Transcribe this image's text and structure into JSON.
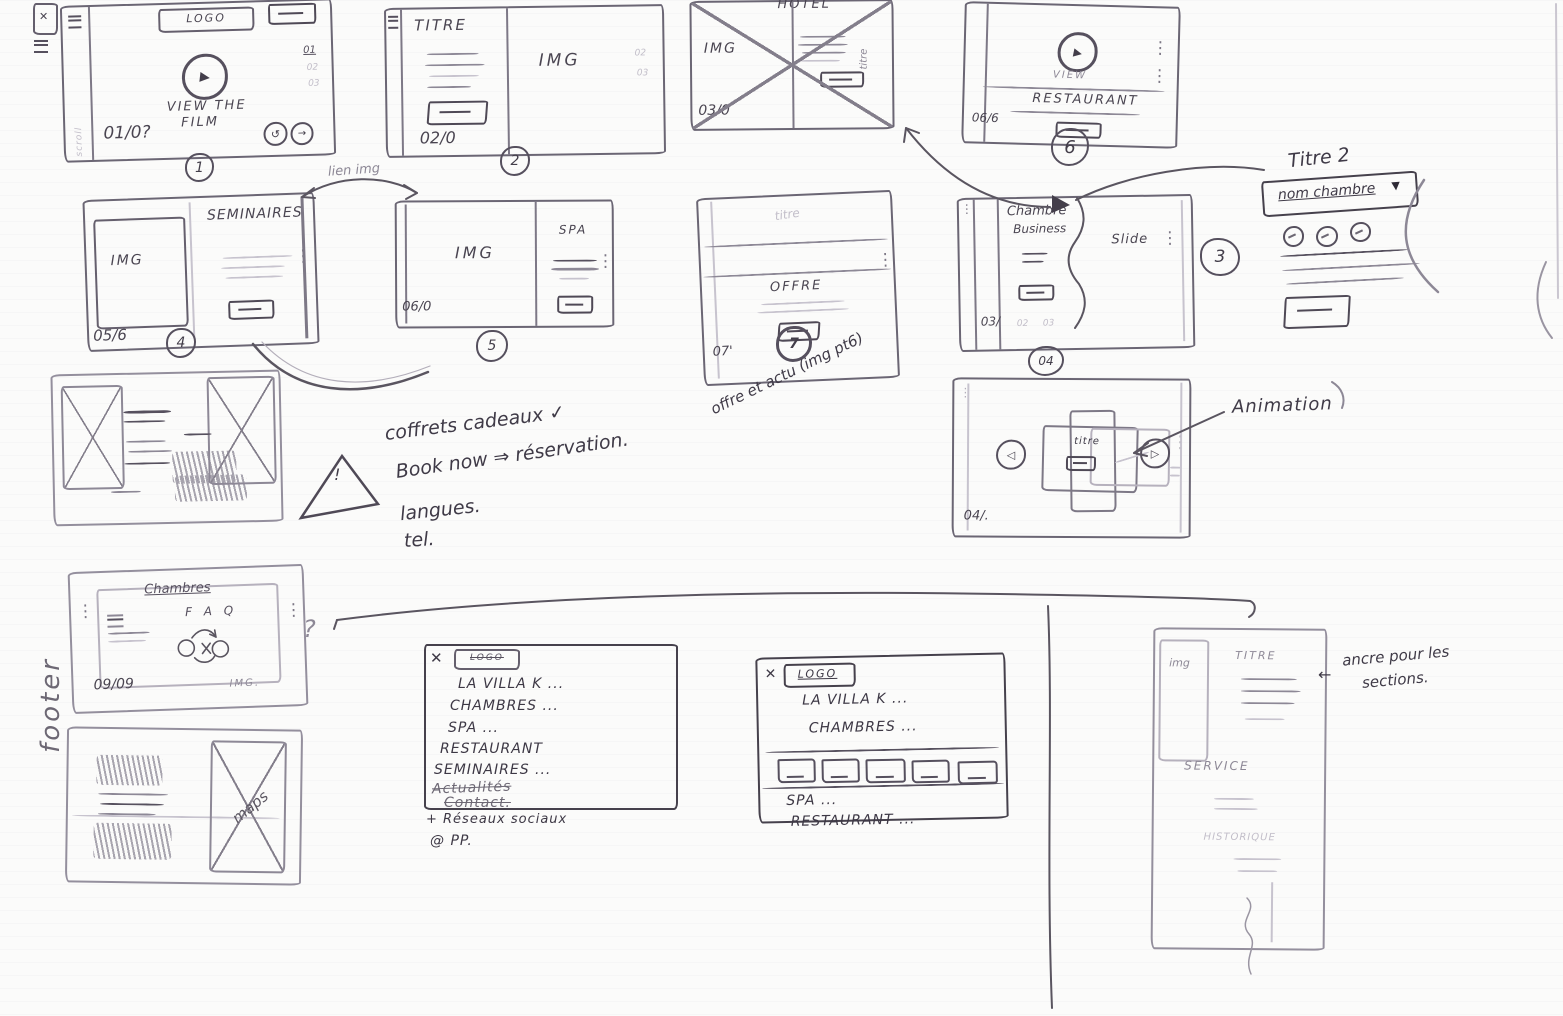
{
  "glyphs": {
    "close": "✕",
    "play": "▶",
    "prev": "◁",
    "next": "▷",
    "caret": "▼",
    "dots": "⋮",
    "loop": "↺",
    "arrow_right": "→",
    "arrow_left": "←"
  },
  "frames": {
    "home": {
      "logo": "LOGO",
      "cta_line1": "VIEW THE",
      "cta_line2": "FILM",
      "page": "01/0?",
      "badge": "1",
      "pager": [
        "01",
        "02",
        "03"
      ],
      "scroll": "scroll"
    },
    "titre": {
      "title": "TITRE",
      "img": "IMG",
      "page": "02/0",
      "badge": "2",
      "pager": [
        "02",
        "03"
      ]
    },
    "hotel": {
      "title": "HOTEL",
      "img": "IMG",
      "page": "03/0",
      "side_label": "titre"
    },
    "restaurant": {
      "view": "VIEW",
      "title": "RESTAURANT",
      "page": "06/6",
      "badge": "6"
    },
    "seminaires": {
      "img": "IMG",
      "title": "SEMINAIRES",
      "page": "05/6",
      "badge": "4"
    },
    "spa": {
      "img": "IMG",
      "title": "SPA",
      "page": "06/0",
      "badge": "5"
    },
    "offre": {
      "band": "titre",
      "title": "OFFRE",
      "page": "07'",
      "badge": "7"
    },
    "chambre": {
      "title_line1": "Chambre",
      "title_line2": "Business",
      "slide": "Slide",
      "page": "03/",
      "marks": [
        "02",
        "03"
      ],
      "badge_side": "3",
      "badge_below": "04"
    },
    "room_detail": {
      "title": "Titre 2",
      "dropdown": "nom chambre"
    },
    "animation": {
      "label": "Animation",
      "title": "titre",
      "page": "04/."
    },
    "faq": {
      "strike_title": "Chambres",
      "title": "F A Q",
      "page": "09/09",
      "img": "IMG.",
      "question": "?"
    },
    "maps": {
      "label": "maps"
    },
    "anchor": {
      "img": "img",
      "title": "TITRE",
      "section2": "SERVICE",
      "section3": "HISTORIQUE"
    }
  },
  "menus": {
    "menu1": {
      "logo": "LOGO",
      "items": [
        "LA VILLA K ...",
        "CHAMBRES ...",
        "SPA ...",
        "RESTAURANT",
        "SEMINAIRES ...",
        "Actualités",
        "Contact."
      ],
      "social": "+ Réseaux sociaux",
      "pp": "@ PP."
    },
    "menu2": {
      "logo": "LOGO",
      "items_top": [
        "LA VILLA K ...",
        "CHAMBRES ..."
      ],
      "items_bottom": [
        "SPA ...",
        "RESTAURANT ..."
      ]
    }
  },
  "annotations": {
    "lien_img": "lien img",
    "offre_note": "offre et actu (img pt6)",
    "checklist": [
      "coffrets cadeaux ✓",
      "Book now ⇒ réservation.",
      "langues.",
      "tel."
    ],
    "warning": "!",
    "footer": "footer",
    "anchor_line1": "ancre pour les",
    "anchor_line2": "sections."
  },
  "colors": {
    "ink": "#433e4a",
    "pen": "#5a5560",
    "pencil": "#8d8896"
  }
}
